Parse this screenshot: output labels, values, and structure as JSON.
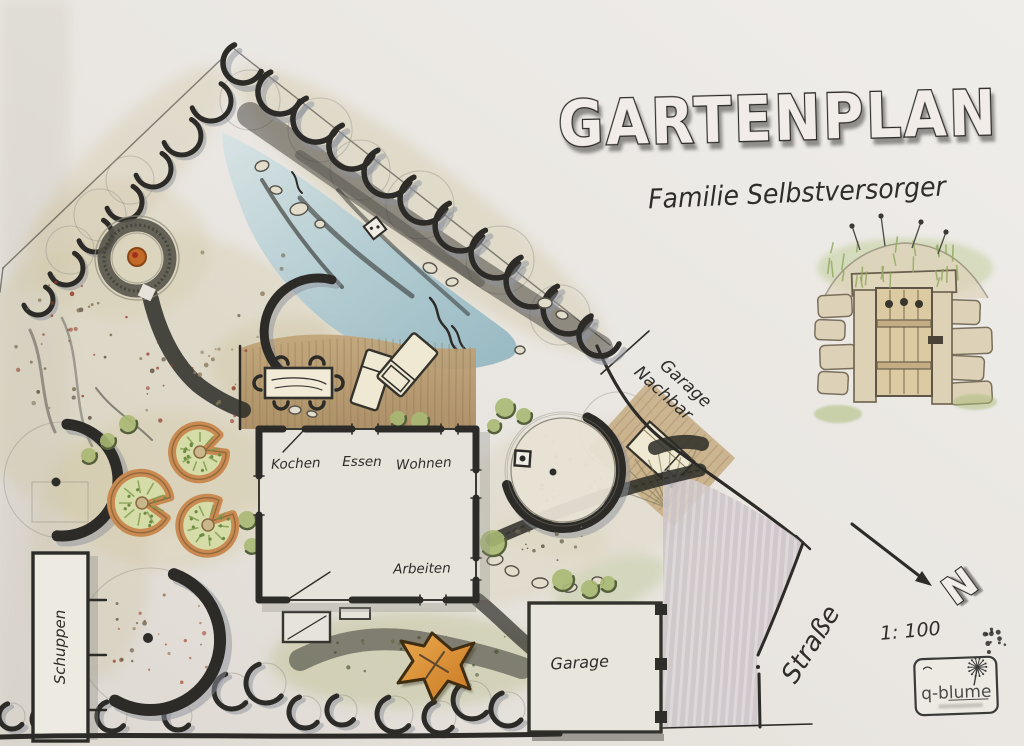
{
  "title": "GARTENPLAN",
  "subtitle": "Familie Selbstversorger",
  "house": {
    "rooms": {
      "kochen": "Kochen",
      "essen": "Essen",
      "wohnen": "Wohnen",
      "arbeiten": "Arbeiten"
    }
  },
  "labels": {
    "shed": "Schuppen",
    "garage": "Garage",
    "neighbor_line1": "Garage",
    "neighbor_line2": "Nachbar",
    "street": "Straße",
    "scale": "1: 100",
    "north": "N"
  },
  "logo": {
    "text": "q-blume"
  },
  "colors": {
    "paper": "#e9e6e1",
    "ink": "#2c2b27",
    "pond": "#9dbfca",
    "deck_wood": "#b59a72",
    "hedge_green": "#9cb168",
    "bed_rim_orange": "#c98a52",
    "fire_orange": "#c46a28",
    "play_orange": "#dd8f33",
    "street_hatch": "#cfc8cc"
  }
}
